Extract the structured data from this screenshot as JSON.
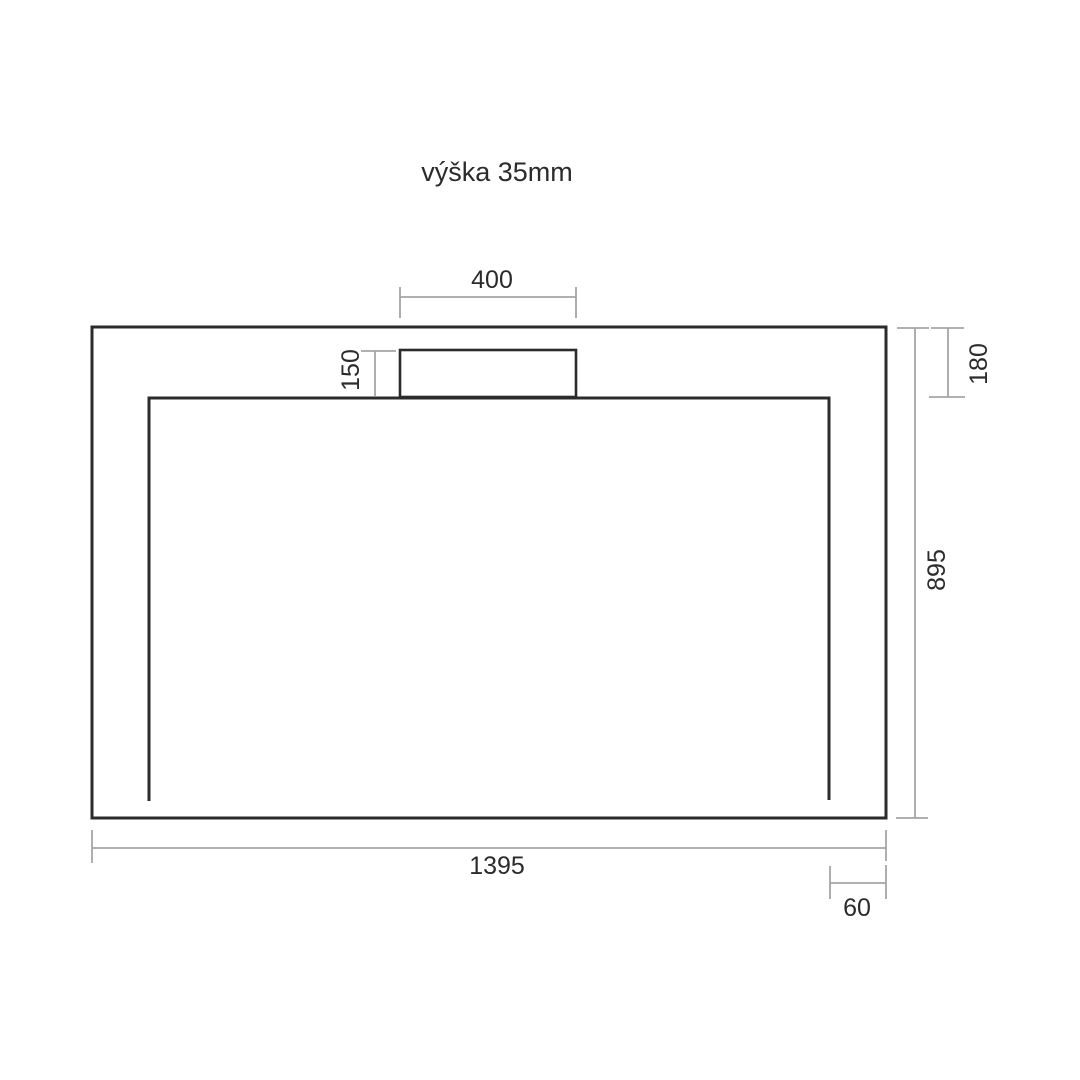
{
  "title": "výška 35mm",
  "dimensions": {
    "drain_width": "400",
    "drain_offset": "150",
    "top_inset": "180",
    "overall_height": "895",
    "overall_width": "1395",
    "right_inset": "60"
  },
  "colors": {
    "outline": "#2b2b2b",
    "dimension_line": "#a5a5a5",
    "text": "#2b2b2b",
    "background": "#ffffff"
  }
}
